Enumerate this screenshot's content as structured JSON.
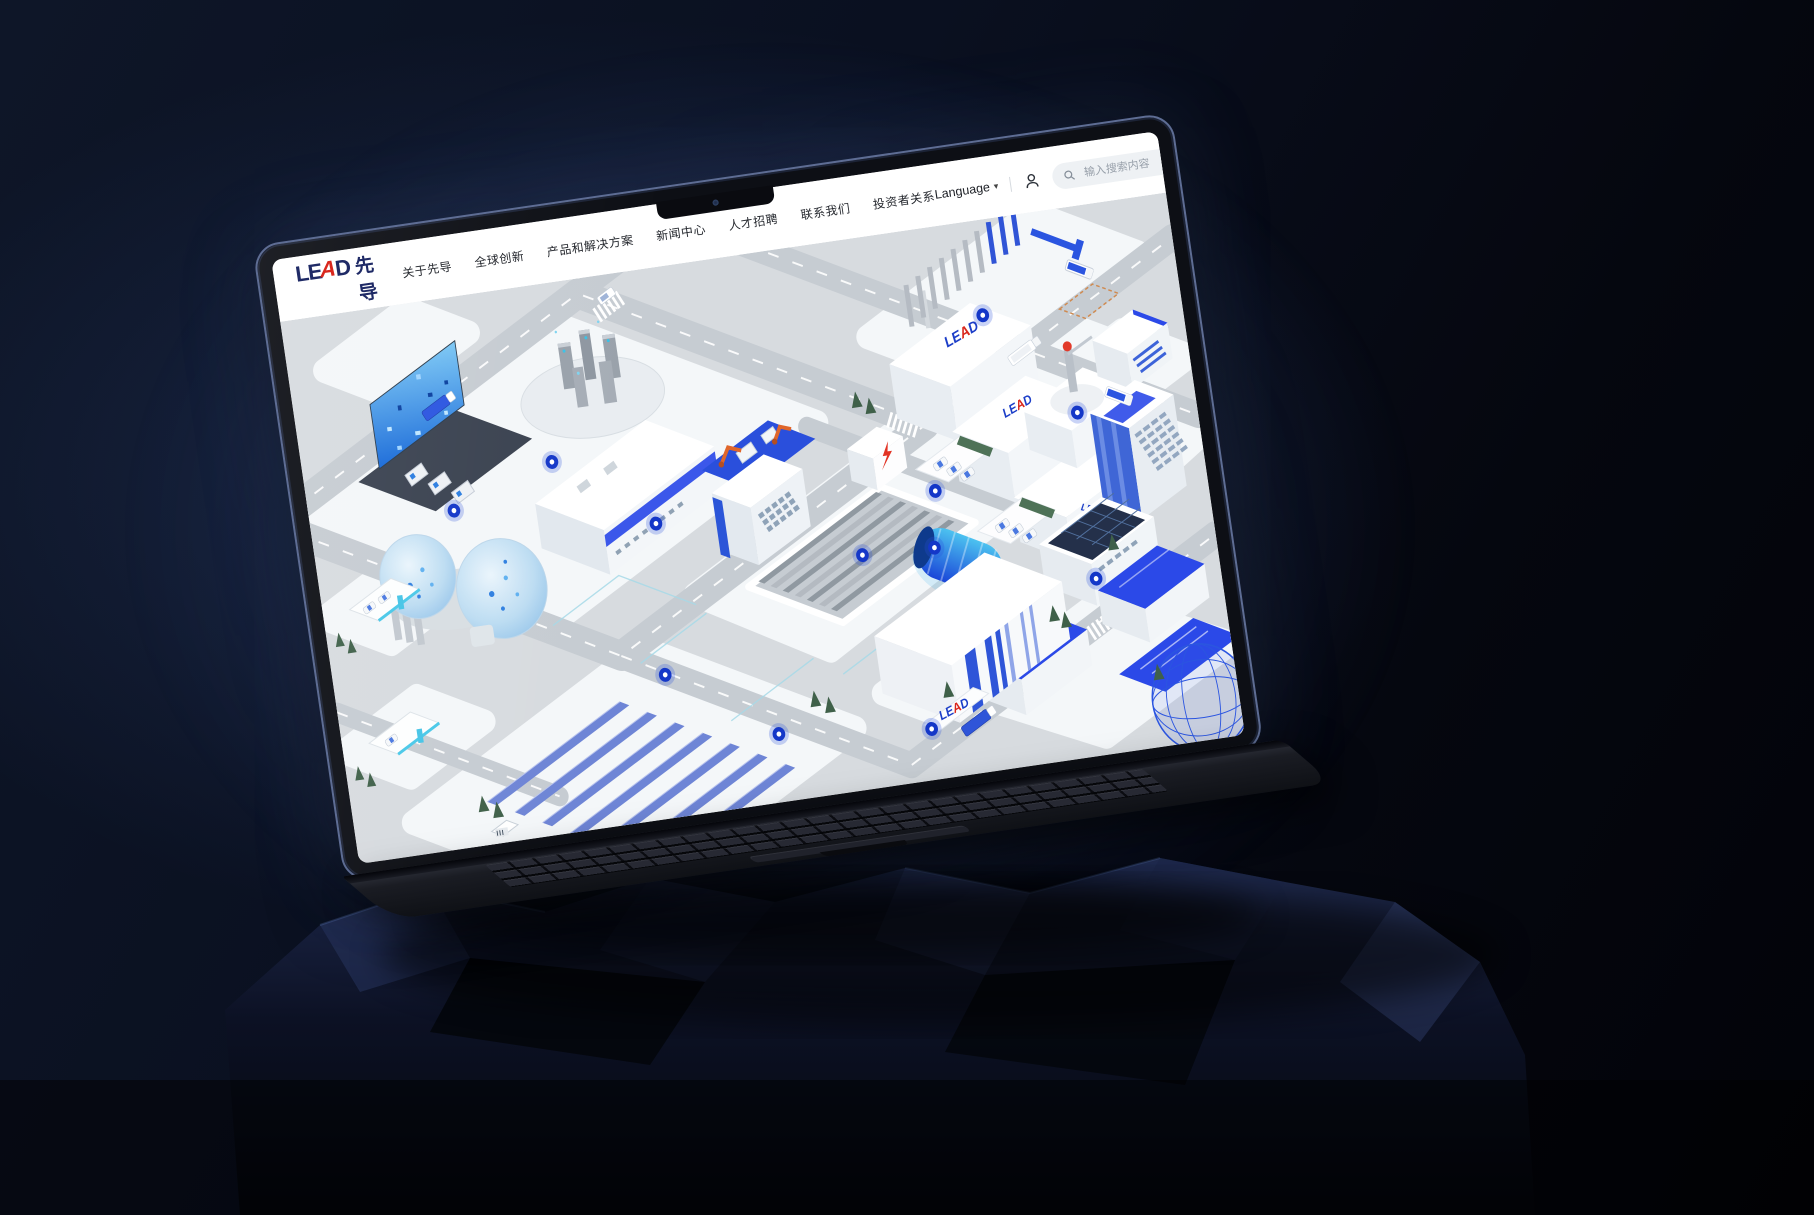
{
  "header": {
    "logo": {
      "lead_pre": "LE",
      "lead_a": "A",
      "lead_post": "D",
      "logo_cn": "先导"
    },
    "nav": [
      "关于先导",
      "全球创新",
      "产品和解决方案",
      "新闻中心",
      "人才招聘",
      "联系我们",
      "投资者关系"
    ],
    "language": {
      "label": "Language",
      "caret": "▾"
    },
    "icons": {
      "user": "user-account-icon",
      "search": "search-icon"
    },
    "search": {
      "placeholder": "输入搜索内容"
    }
  },
  "map": {
    "sign": {
      "pre": "LE",
      "a": "A",
      "post": "D"
    }
  },
  "colors": {
    "brand_navy": "#1f2a66",
    "brand_red": "#d9271d",
    "accent_blue": "#2b49e8",
    "hotspot_blue": "#1437c8",
    "accent_cyan": "#49c8e8",
    "map_ground": "#d7dbdf"
  }
}
